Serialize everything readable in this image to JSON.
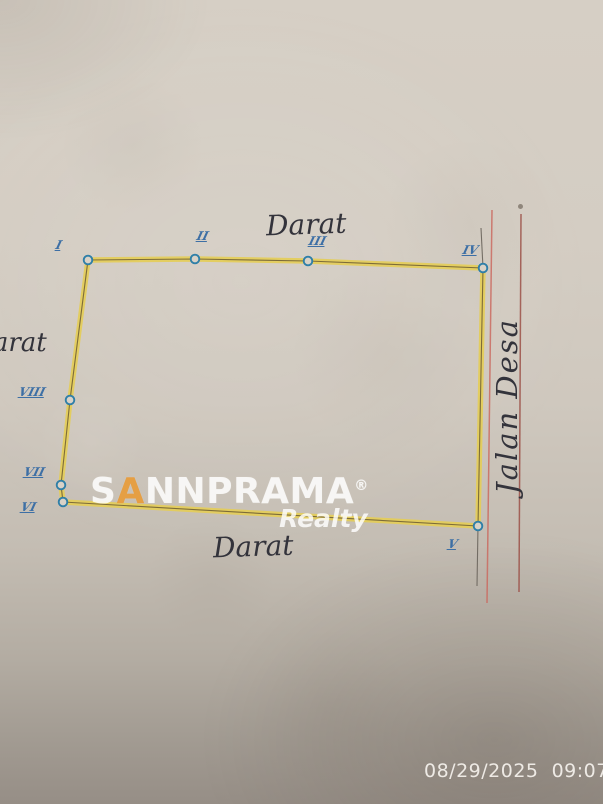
{
  "plot": {
    "area_labels": {
      "top": "Darat",
      "bottom": "Darat",
      "left": "Darat",
      "road": "Jalan Desa"
    },
    "points": [
      {
        "numeral": "I",
        "x": 88,
        "y": 260,
        "label_x": 56,
        "label_y": 238
      },
      {
        "numeral": "II",
        "x": 195,
        "y": 259,
        "label_x": 197,
        "label_y": 229
      },
      {
        "numeral": "III",
        "x": 308,
        "y": 261,
        "label_x": 309,
        "label_y": 234
      },
      {
        "numeral": "IV",
        "x": 483,
        "y": 268,
        "label_x": 463,
        "label_y": 243
      },
      {
        "numeral": "V",
        "x": 478,
        "y": 526,
        "label_x": 448,
        "label_y": 537
      },
      {
        "numeral": "VI",
        "x": 63,
        "y": 502,
        "label_x": 21,
        "label_y": 500
      },
      {
        "numeral": "VII",
        "x": 61,
        "y": 485,
        "label_x": 24,
        "label_y": 465
      },
      {
        "numeral": "VIII",
        "x": 70,
        "y": 400,
        "label_x": 19,
        "label_y": 385
      }
    ],
    "extension_lines": [
      {
        "x1": 483,
        "y1": 268,
        "x2": 481,
        "y2": 228
      },
      {
        "x1": 478,
        "y1": 526,
        "x2": 477,
        "y2": 586
      }
    ],
    "road_lines": [
      {
        "x1": 492,
        "y1": 210,
        "x2": 487,
        "y2": 603,
        "color": "#cb6b61"
      },
      {
        "x1": 521,
        "y1": 214,
        "x2": 519,
        "y2": 592,
        "color": "#9c5148"
      }
    ],
    "colors": {
      "boundary_yellow": "#e4cd58",
      "boundary_ink": "#6b5a33",
      "vertex_ring": "#2f7fa8",
      "vertex_fill": "#d9d2c7",
      "extension": "#6a645c",
      "numeral_blue": "#3d6fa5",
      "ink": "#33333b"
    }
  },
  "watermark": {
    "part1": "S",
    "part2": "A",
    "part3": "NNPRAMA",
    "reg": "®",
    "sub": "Realty",
    "accent_color": "#e69a38"
  },
  "camera": {
    "timestamp": "08/29/2025  09:07"
  }
}
